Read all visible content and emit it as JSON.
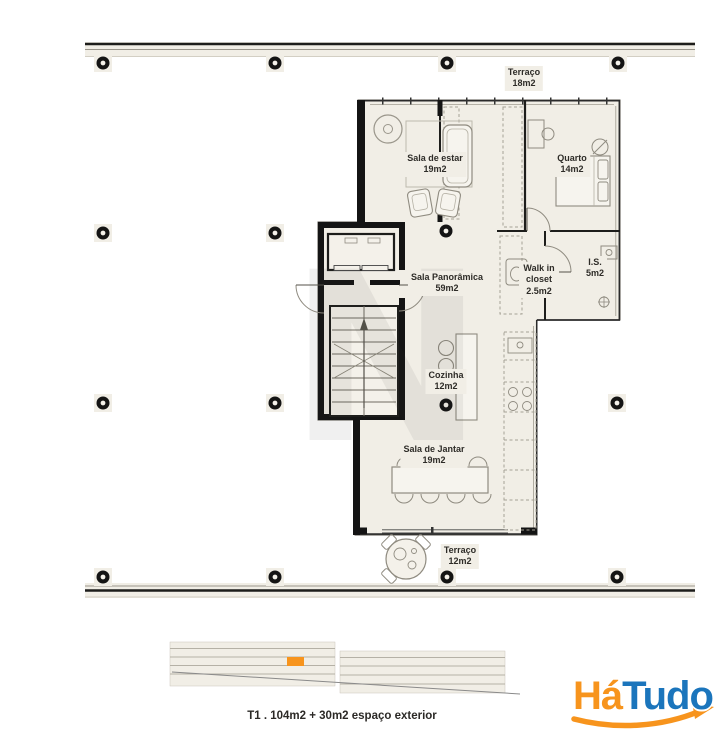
{
  "plan": {
    "rooms": [
      {
        "name": "Terraço",
        "area": "18m2"
      },
      {
        "name": "Sala de estar",
        "area": "19m2"
      },
      {
        "name": "Quarto",
        "area": "14m2"
      },
      {
        "name": "Sala Panorâmica",
        "area": "59m2"
      },
      {
        "name": "Walk in closet",
        "area": "2.5m2"
      },
      {
        "name": "I.S.",
        "area": "5m2"
      },
      {
        "name": "Cozinha",
        "area": "12m2"
      },
      {
        "name": "Sala de Jantar",
        "area": "19m2"
      },
      {
        "name": "Terraço",
        "area": "12m2"
      }
    ],
    "caption": "T1 . 104m2 + 30m2 espaço exterior",
    "watermark": "N"
  },
  "logo": {
    "part1": "Há",
    "part2": "Tudo"
  },
  "colors": {
    "floor": "#f1eee6",
    "wall": "#141414",
    "logo_orange": "#F7941D",
    "logo_blue": "#1B75BC",
    "elevation_highlight": "#F7941D"
  }
}
